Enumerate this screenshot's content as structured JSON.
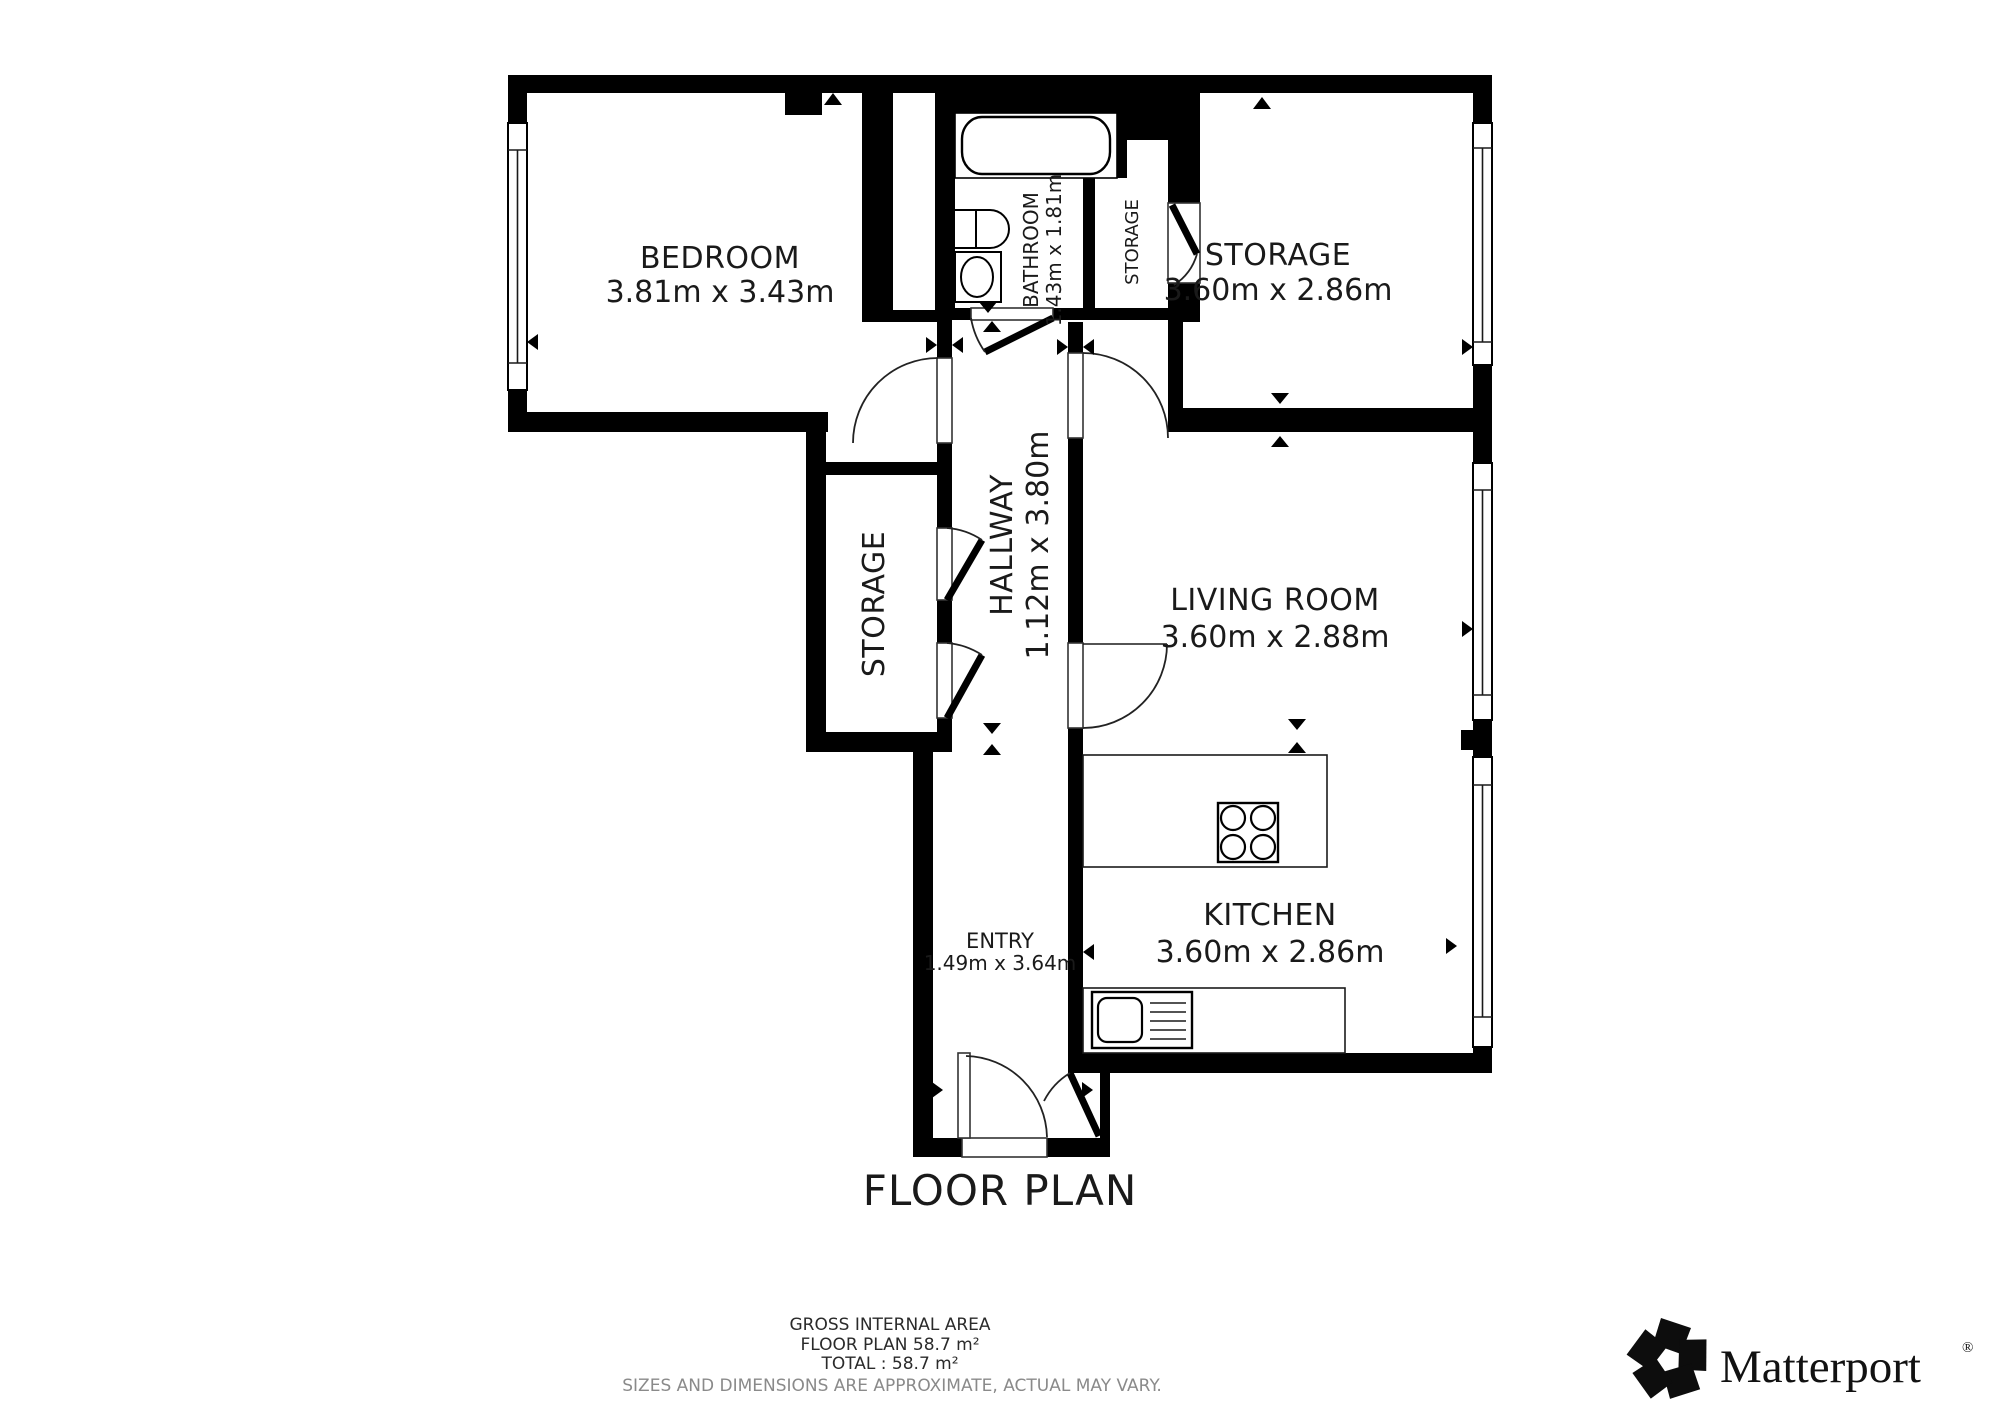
{
  "title": "FLOOR PLAN",
  "rooms": {
    "bedroom": {
      "name": "BEDROOM",
      "dims": "3.81m x 3.43m"
    },
    "bathroom": {
      "name": "BATHROOM",
      "dims": "1.43m x 1.81m"
    },
    "closet": {
      "name": "STORAGE"
    },
    "storage": {
      "name": "STORAGE",
      "dims": "3.60m x 2.86m"
    },
    "hall_storage": {
      "name": "STORAGE"
    },
    "hallway": {
      "name": "HALLWAY",
      "dims": "1.12m x 3.80m"
    },
    "living": {
      "name": "LIVING ROOM",
      "dims": "3.60m x 2.88m"
    },
    "kitchen": {
      "name": "KITCHEN",
      "dims": "3.60m x 2.86m"
    },
    "entry": {
      "name": "ENTRY",
      "dims": "1.49m x 3.64m"
    }
  },
  "footer": {
    "area_title": "GROSS INTERNAL AREA",
    "floor": "FLOOR PLAN 58.7 m²",
    "total": "TOTAL :  58.7 m²",
    "disclaimer": "SIZES AND DIMENSIONS ARE APPROXIMATE, ACTUAL MAY VARY."
  },
  "brand": {
    "name": "Matterport",
    "registered": "®"
  },
  "colors": {
    "wall": "#000000",
    "text": "#1a1a1a",
    "muted": "#8a8a8a",
    "background": "#ffffff"
  }
}
